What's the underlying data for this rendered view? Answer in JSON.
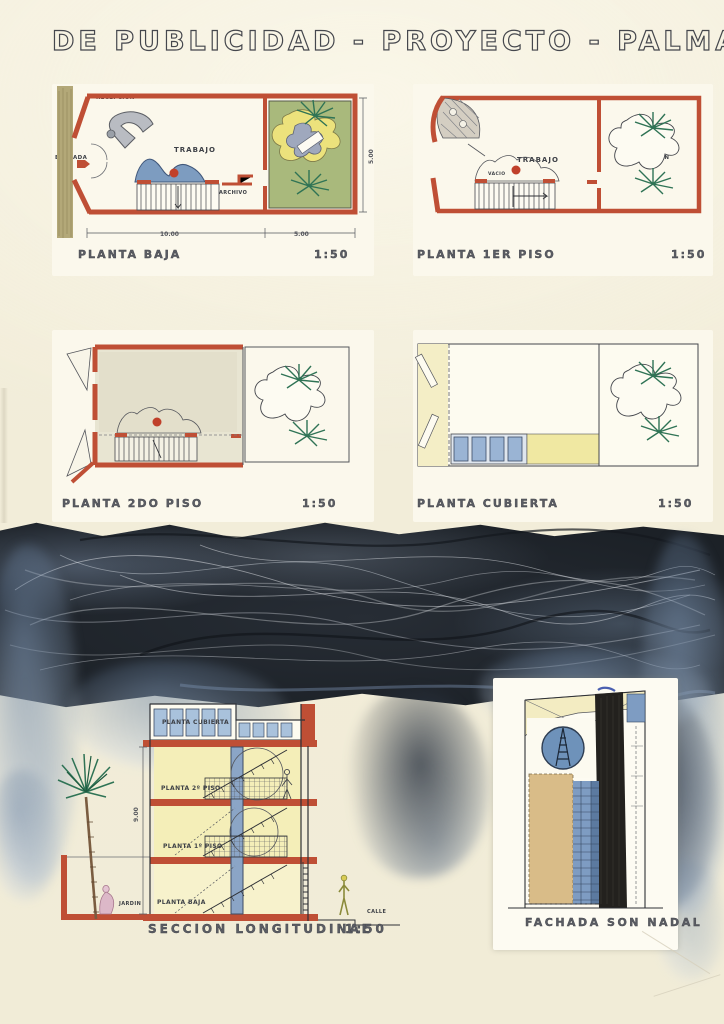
{
  "board": {
    "title": "DE PUBLICIDAD - PROYECTO - PALMA"
  },
  "plans": {
    "planta_baja": {
      "caption": "PLANTA BAJA",
      "scale": "1:50",
      "labels": {
        "recepcion": "RECEPCION",
        "entrada": "ENTRADA",
        "trabajo": "TRABAJO",
        "archivo": "ARCHIVO",
        "terraza": "TERRAZA",
        "jardin": "JARDIN"
      },
      "dims": {
        "main_width": "10.00",
        "garden_width": "5.00",
        "depth": "5.00"
      }
    },
    "planta_1er": {
      "caption": "PLANTA 1ER PISO",
      "scale": "1:50",
      "labels": {
        "trabajo": "TRABAJO",
        "vacio": "VACIO",
        "vacio_jardin": "VACIO JARDIN"
      }
    },
    "planta_2do": {
      "caption": "PLANTA 2DO PISO",
      "scale": "1:50",
      "labels": {
        "trabajo": "TRABAJO",
        "vacio": "VACIO",
        "vacio_jardin": "VACIO JARDIN"
      }
    },
    "planta_cubierta": {
      "caption": "PLANTA CUBIERTA",
      "scale": "1:50",
      "labels": {
        "vacio_jardin": "VACIO JARDIN"
      }
    }
  },
  "section": {
    "caption": "SECCION LONGITUDINAL",
    "scale": "1:50",
    "labels": {
      "planta_cubierta": "PLANTA CUBIERTA",
      "planta_2": "PLANTA 2º PISO",
      "planta_1": "PLANTA 1º PISO",
      "planta_baja": "PLANTA BAJA",
      "jardin": "JARDIN",
      "calle": "CALLE"
    },
    "dims": {
      "height": "9.00"
    }
  },
  "facade": {
    "caption": "FACHADA SON NADAL"
  },
  "colors": {
    "paper": "#f2edd9",
    "wall_red": "#bf4f35",
    "blue": "#7d9cc0",
    "yellow": "#efe79e",
    "garden_green": "#a9b97c",
    "palm_green": "#2f7355",
    "ink": "#3d4046",
    "charcoal_band": "#20262d",
    "smudge_blue": "#8ba3bc",
    "tan": "#dcc08c"
  }
}
